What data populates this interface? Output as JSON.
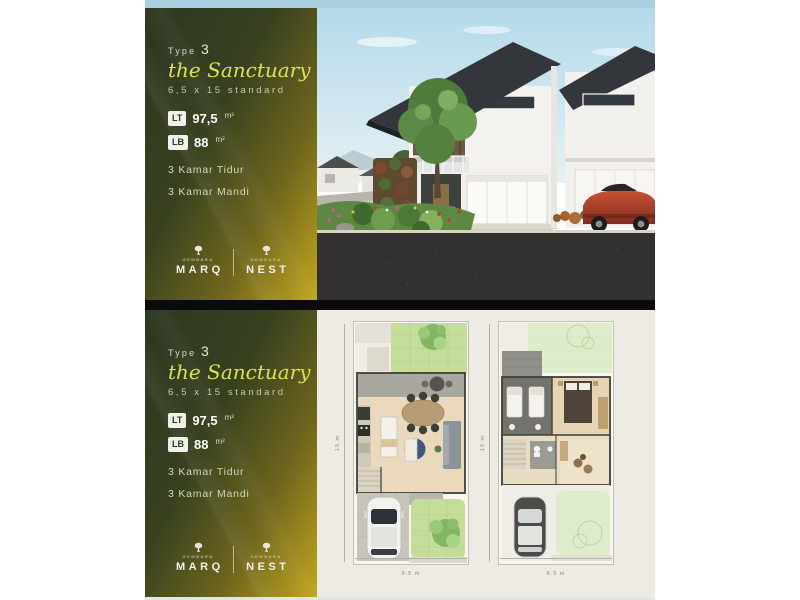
{
  "brand": {
    "sub": "GEMBARA",
    "left_word": "MARQ",
    "right_word": "NEST"
  },
  "panel": {
    "type_label": "Type",
    "type_number": "3",
    "name": "the Sanctuary",
    "size_line": "6,5 x 15 standard",
    "lt_badge": "LT",
    "lt_value": "97,5",
    "lt_unit": "m²",
    "lb_badge": "LB",
    "lb_value": "88",
    "lb_unit": "m²",
    "features": [
      "3 Kamar Tidur",
      "3 Kamar Mandi"
    ]
  },
  "floorplans": {
    "height_label": "15 m",
    "width_label": "6.5 m"
  },
  "colors": {
    "panel_dark": "#2c3722",
    "panel_gold": "#c2a51d",
    "script_yellow": "#dce24f",
    "sky_sliver": "#a9cfdf",
    "separator": "#0b0b0b",
    "plans_background": "#edebe3",
    "garden_green": "#c5dc9b",
    "roof_dark": "#33363a",
    "car_red": "#b5432e"
  }
}
